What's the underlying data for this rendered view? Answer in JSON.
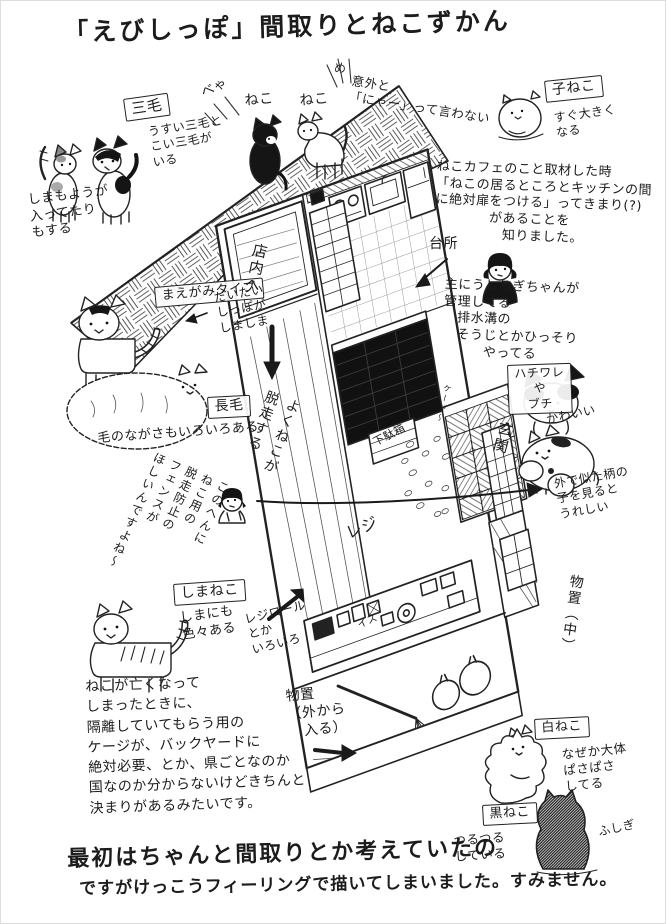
{
  "title": "「えびしっぽ」間取りとねこずかん",
  "top_left": {
    "mike_label": "三毛",
    "mike_note1": "うすい三毛と\nこい三毛が\nいる",
    "mike_note2": "しまもようが\n入ってたり\nもする"
  },
  "roof": {
    "cat1_sound": "べゃ",
    "cat1_label": "ねこ",
    "cat2_label": "ねこ",
    "cat2_sound": "め",
    "note": "意外と\n「にゃー」って言わない"
  },
  "top_right": {
    "koneko_label": "子ねこ",
    "koneko_note": "すぐ大きく\nなる",
    "cafe_note": "ねこカフェのこと取材した時\n「ねこの居るところとキッチンの間\nに絶対扉をつける」ってきまり(?)\n　　　　があることを\n　　　　　知りました。",
    "kitchen_label": "台所",
    "manage_note": "主にうしろぎちゃんが\n管理してる\n　排水溝の\n　そうじとかひっそり\n　　　やってる"
  },
  "right_side": {
    "hachiware_label": "ハチワレ\nや\nブチ",
    "kawaii_note": "かわいい",
    "genkan_label": "玄関",
    "similar_note": "外で似た柄の\n子を見ると\nうれしい",
    "monooki_naka_label": "物置（中）"
  },
  "left_side": {
    "maegami_label": "まえがみタイプ",
    "tail_note": "だいたい\nしっぽが\nしましま",
    "chomo_label": "長毛",
    "fur_note": "毛のながさもいろいろある",
    "fence_note": "このへんに\nねこ用の\n脱走防止の\nフェンスが\nほしいんですよね〜",
    "shimaneko_label": "しまねこ",
    "shima_note": "しまにも\n色々ある"
  },
  "floorplan": {
    "door_label": "店内へ",
    "escape_note": "よくねこが\n脱走する",
    "getabako_label": "下駄箱",
    "cage_label": "ケージ〜",
    "reji_label": "レジ",
    "isu_label": "イス",
    "rejiroll_note": "レジロール\nとか\nいろいろ",
    "monooki_soto_label": "物置\n（外から\n　入る）"
  },
  "bottom": {
    "rule_note": "ねこが亡くなって\nしまったときに、\n隔離していてもらう用の\nケージが、バックヤードに\n絶対必要、とか、県ごとなのか\n国なのか分からないけどきちんと\n決まりがあるみたいです。",
    "shironeko_label": "白ねこ",
    "shiro_note": "なぜか大体\nぱさぱさ\nしてる",
    "kuroneko_label": "黒ねこ",
    "kuro_note": "つるつる\nしている",
    "fushigi_note": "ふしぎ",
    "closing_note1": "最初はちゃんと間取りとか考えていたの",
    "closing_note2": "ですがけっこうフィーリングで描いてしまいました。すみません。"
  }
}
